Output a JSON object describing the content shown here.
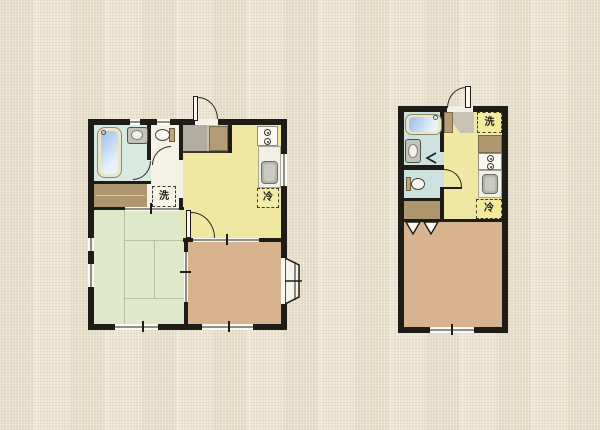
{
  "palette": {
    "background": "#ece4d1",
    "wall": "#1f1c17",
    "floor_hall": "#f4f1e6",
    "floor_kitchen": "#f0e7a3",
    "floor_tatami": "#dfe9c9",
    "floor_wood": "#d7b48f",
    "floor_bath_left": "#d8e9e1",
    "floor_bath_right": "#cde2df",
    "closet_brown": "#ae976f",
    "genkan_gray": "#c7c4b6",
    "genkan_step_gray": "#b1aea1",
    "cabinet_brown": "#b59c74",
    "tub_blue": "#a8c6ec",
    "sink_gray": "#b4b5ad",
    "fixture_white": "#fbf9f1"
  },
  "plans": {
    "left": {
      "labels": {
        "washing_machine": "洗",
        "refrigerator": "冷"
      }
    },
    "right": {
      "labels": {
        "washing_machine": "洗",
        "refrigerator": "冷"
      }
    }
  }
}
